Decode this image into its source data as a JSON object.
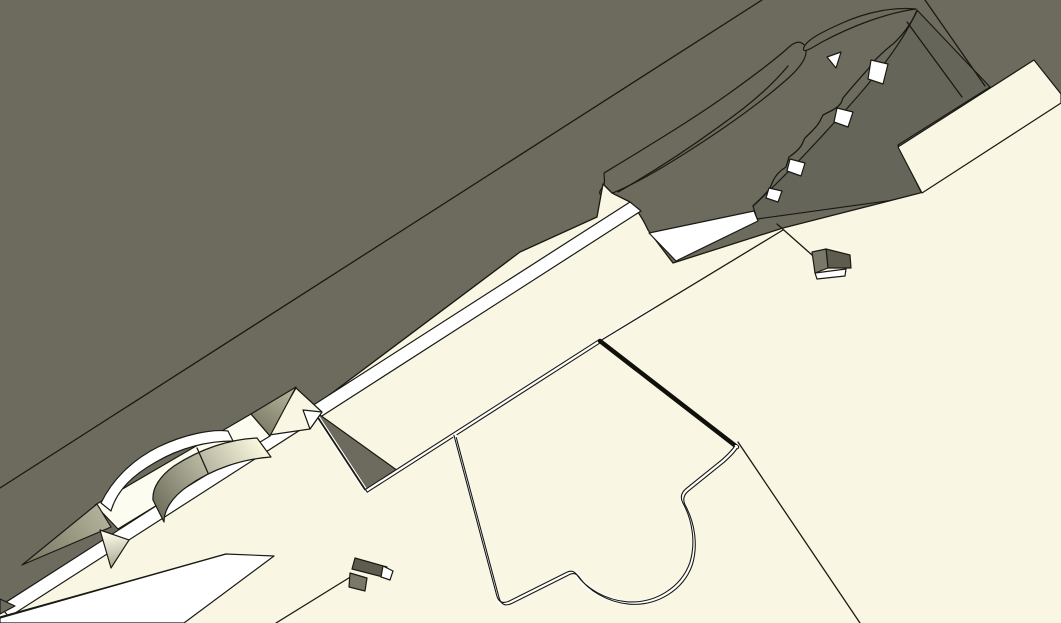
{
  "meta": {
    "app_type": "3d-cad-viewport",
    "description": "Close-up shaded view of CAD assembly: olive-grey slab surfaces behind cream plates with black feature edges, star-shaped extrusion with curved wall, small block features and slotted holes",
    "viewport": {
      "width": 1061,
      "height": 623
    }
  },
  "colors": {
    "bg": "#6c6b5d",
    "band_dark": "#66655a",
    "cream": "#f9f7e3",
    "cream_bright": "#fdfcf0",
    "white": "#ffffff",
    "box_dark": "#5d5c4f",
    "box_mid": "#7a7868",
    "sage_light": "#b2b199",
    "sage_dark": "#75745f",
    "wall_light": "#f8f6dd",
    "wall_dark": "#6e6d5b",
    "down_light": "#fbfae9",
    "down_dark": "#a5a48e",
    "line": "#1a1a14"
  },
  "shapes": {
    "slab_edge_line": {
      "d": "M 0,488 L 762,0"
    },
    "dark_band": {
      "d": "M 753,206 C 790,172 828,130 858,96 C 884,66 906,36 917,10 L 990,87 L 898,145 L 923,196 L 757,219 Z"
    },
    "wavy_edge": {
      "d": "M 753,206 C 760,199 766,194 770,188 L 773,181 C 776,174 781,170 786,167 L 789,157 C 795,153 801,148 803,142 L 805,138 C 811,132 818,126 821,119 L 823,115 C 830,111 837,109 841,103 L 843,98 C 851,88 861,77 869,68 L 871,64 C 878,57 886,49 893,44 C 903,35 912,22 917,11"
    },
    "feather_outline": {
      "d": "M 604,173 C 642,150 692,120 731,92 C 756,74 777,58 789,47 C 798,39 805,42 806,50 C 807,58 799,69 785,81 C 754,108 713,136 676,159 C 649,176 624,189 610,194 C 600,197 597,194 602,188 C 606,183 604,178 604,173 Z"
    },
    "feather_inner": {
      "d": "M 618,192 C 660,168 706,137 744,108 C 763,93 778,78 788,66"
    },
    "spike_sliver": {
      "d": "M 916,9 C 886,13 852,26 822,42 C 812,48 801,55 804,47 C 807,40 820,33 840,24 C 868,11 895,7 916,9 Z"
    },
    "post_line_1": {
      "d": "M 925,0 L 985,86"
    },
    "post_line_2": {
      "d": "M 907,22 L 962,97"
    },
    "hole_a": {
      "d": "M 827,57 L 841,52 L 836,68 Z"
    },
    "hole_b": {
      "d": "M 871,60 L 888,64 L 883,84 L 868,79 Z"
    },
    "hole_c": {
      "d": "M 837,108 L 853,112 L 848,127 L 834,122 Z"
    },
    "hole_d": {
      "d": "M 790,159 L 805,163 L 801,176 L 787,171 Z"
    },
    "hole_e": {
      "d": "M 769,188 L 782,191 L 778,202 L 766,198 Z"
    },
    "wedge_top_right": {
      "d": "M 898,147 L 1034,60 L 1061,94 L 1061,103 L 922,193 Z"
    },
    "main_cream": {
      "d": "M 0,623 L 0,606 L 312,408 L 520,252 L 597,217 L 603,184 L 612,193 L 630,202 C 638,211 643,219 648,230 L 673,263 L 783,228 L 920,193 L 1061,100 L 1061,623 Z"
    },
    "mega_boundary": {
      "d": "M 0,606 L 312,408 L 520,252 L 597,217 L 603,184 L 612,193 L 630,202 C 638,211 643,219 648,230 L 673,263 L 783,228 L 920,193 L 1061,100"
    },
    "strip_left": {
      "d": "M 0,606 L 630,202 L 641,211 L 9,617 Z"
    },
    "grey_lower_wedge": {
      "d": "M 0,617 L 226,554 L 178,621 Z"
    },
    "strip_lower": {
      "d": "M 0,623 L 0,618 L 226,554 L 274,556 L 184,623 Z"
    },
    "strip_mid": {
      "d": "M 649,233 L 754,211 L 758,221 L 676,261 Z"
    },
    "grey_notch": {
      "d": "M 313,410 L 366,491 L 398,471 Z"
    },
    "plate_edge_right": {
      "d": "M 600,341 L 783,230"
    },
    "plate_edge_right_hi": {
      "d": "M 600,341 L 656,307"
    },
    "upper_edge": {
      "d": "M 313,410 L 366,491 L 600,341"
    },
    "gap_thick": {
      "d": "M 600,341 L 737,447"
    },
    "lower_edge": {
      "d": "M 455,436 L 498,597 Q 501,607 511,602 L 567,574 Q 574,570 578,576 C 587,589 606,601 628,603 C 656,605 682,589 691,564 C 697,545 694,522 684,504 Q 680,496 687,490 L 723,461 Q 733,452 736,447"
    },
    "lower_plate_edge": {
      "d": "M 738,442 L 860,623"
    },
    "line_to_box": {
      "d": "M 276,623 L 352,576"
    },
    "left_edge_spike": {
      "d": "M 0,599 L 15,606 L 0,614 Z"
    },
    "star_long_spike": {
      "d": "M 22,565 L 97,504 L 111,527 Z"
    },
    "star_upper_spike": {
      "d": "M 251,414 L 296,387 L 270,436 Z"
    },
    "star_flat_tri": {
      "d": "M 269,435 L 296,388 L 322,412 L 310,429 Z"
    },
    "star_right_tip": {
      "d": "M 303,410 L 322,412 L 310,429 Z"
    },
    "star_down_spike": {
      "d": "M 100,530 L 129,540 L 111,568 Z"
    },
    "star_band": {
      "d": "M 95,505 L 251,414 L 270,436 L 118,529 Z"
    },
    "star_arc_white": {
      "d": "M 101,503 C 112,480 132,460 158,447 C 185,434 212,429 228,431 L 233,441 C 207,441 180,448 156,462 C 133,475 117,490 111,511 Z"
    },
    "star_wall": {
      "d": "M 257,438 C 230,439 200,449 174,466 C 160,476 152,488 153,500 L 164,522 C 164,510 172,497 188,486 C 212,469 242,459 271,457 Z"
    },
    "star_wall_divider": {
      "d": "M 197,448 L 208,473"
    },
    "box_r_line": {
      "d": "M 777,224 L 812,255"
    },
    "box_r_dark": {
      "d": "M 826,249 L 850,255 L 851,268 L 828,268 Z"
    },
    "box_r_mid": {
      "d": "M 812,252 L 826,249 L 828,268 L 815,273 Z"
    },
    "box_r_white": {
      "d": "M 815,273 L 846,269 L 845,276 L 817,279 Z"
    },
    "box_l_dark": {
      "d": "M 355,558 L 387,567 L 383,577 L 352,569 Z"
    },
    "box_l_white": {
      "d": "M 383,566 L 393,571 L 390,580 L 381,577 Z"
    },
    "box_l_mid": {
      "d": "M 350,573 L 367,578 L 365,591 L 349,587 Z"
    }
  }
}
